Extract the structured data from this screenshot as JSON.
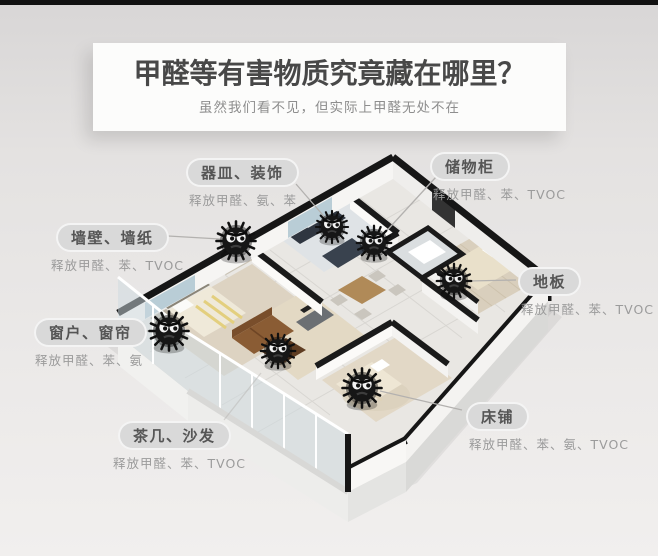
{
  "header": {
    "title": "甲醛等有害物质究竟藏在哪里？",
    "subtitle": "虽然我们看不见，但实际上甲醛无处不在"
  },
  "annotations": [
    {
      "id": "vessels-decor",
      "label": "器皿、装饰",
      "emission": "释放甲醛、氨、苯"
    },
    {
      "id": "storage-cabinet",
      "label": "储物柜",
      "emission": "释放甲醛、苯、TVOC"
    },
    {
      "id": "walls-wallpaper",
      "label": "墙壁、墙纸",
      "emission": "释放甲醛、苯、TVOC"
    },
    {
      "id": "floor",
      "label": "地板",
      "emission": "释放甲醛、苯、TVOC"
    },
    {
      "id": "windows-curtains",
      "label": "窗户、窗帘",
      "emission": "释放甲醛、苯、氨"
    },
    {
      "id": "coffee-table-sofa",
      "label": "茶几、沙发",
      "emission": "释放甲醛、苯、TVOC"
    },
    {
      "id": "bed",
      "label": "床铺",
      "emission": "释放甲醛、苯、氨、TVOC"
    }
  ],
  "illustration": {
    "type": "isometric-apartment-cutaway",
    "monster_count": 7,
    "monsters_at": [
      "墙壁、墙纸",
      "器皿、装饰",
      "储物柜",
      "地板",
      "窗户、窗帘",
      "茶几、沙发",
      "床铺"
    ]
  },
  "colors": {
    "wall_cap": "#161616",
    "pill_bg": "#d9d9d9",
    "pill_text": "#555555",
    "emission_text": "#9b9b9b",
    "title_text": "#484848",
    "subtitle_text": "#8e8e8e"
  }
}
